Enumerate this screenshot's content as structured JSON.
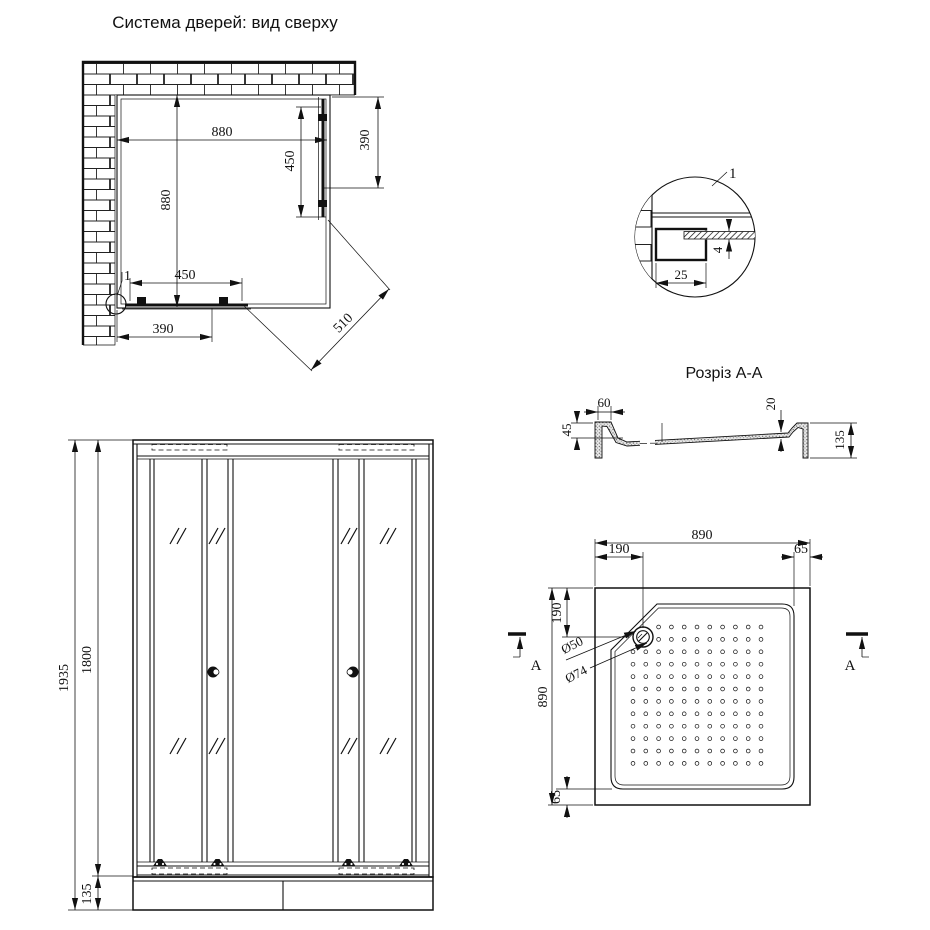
{
  "titles": {
    "top_view": "Система дверей: вид сверху",
    "section": "Розріз А-А"
  },
  "top_view": {
    "dim_width_top": "880",
    "dim_height_left": "880",
    "dim_door_right": "450",
    "dim_opening_right": "390",
    "dim_door_bottom": "450",
    "dim_opening_bottom": "390",
    "dim_diagonal": "510",
    "detail_ref": "1"
  },
  "detail_view": {
    "label": "1",
    "dim_profile_width": "25",
    "dim_glass_thickness": "4"
  },
  "section_view": {
    "dim_rim_width": "60",
    "dim_rim_height": "45",
    "dim_tray_depth": "20",
    "dim_total_height": "135"
  },
  "front_view": {
    "dim_total_height": "1935",
    "dim_door_height": "1800",
    "dim_base_height": "135"
  },
  "tray_view": {
    "dim_width_top": "890",
    "dim_height_left": "890",
    "dim_drain_offset_top": "190",
    "dim_drain_offset_left": "190",
    "dim_rim_top_right": "65",
    "dim_rim_bottom_left": "65",
    "drain_inner_diameter": "Ø50",
    "drain_outer_diameter": "Ø74",
    "section_marker_left": "A",
    "section_marker_right": "A"
  }
}
